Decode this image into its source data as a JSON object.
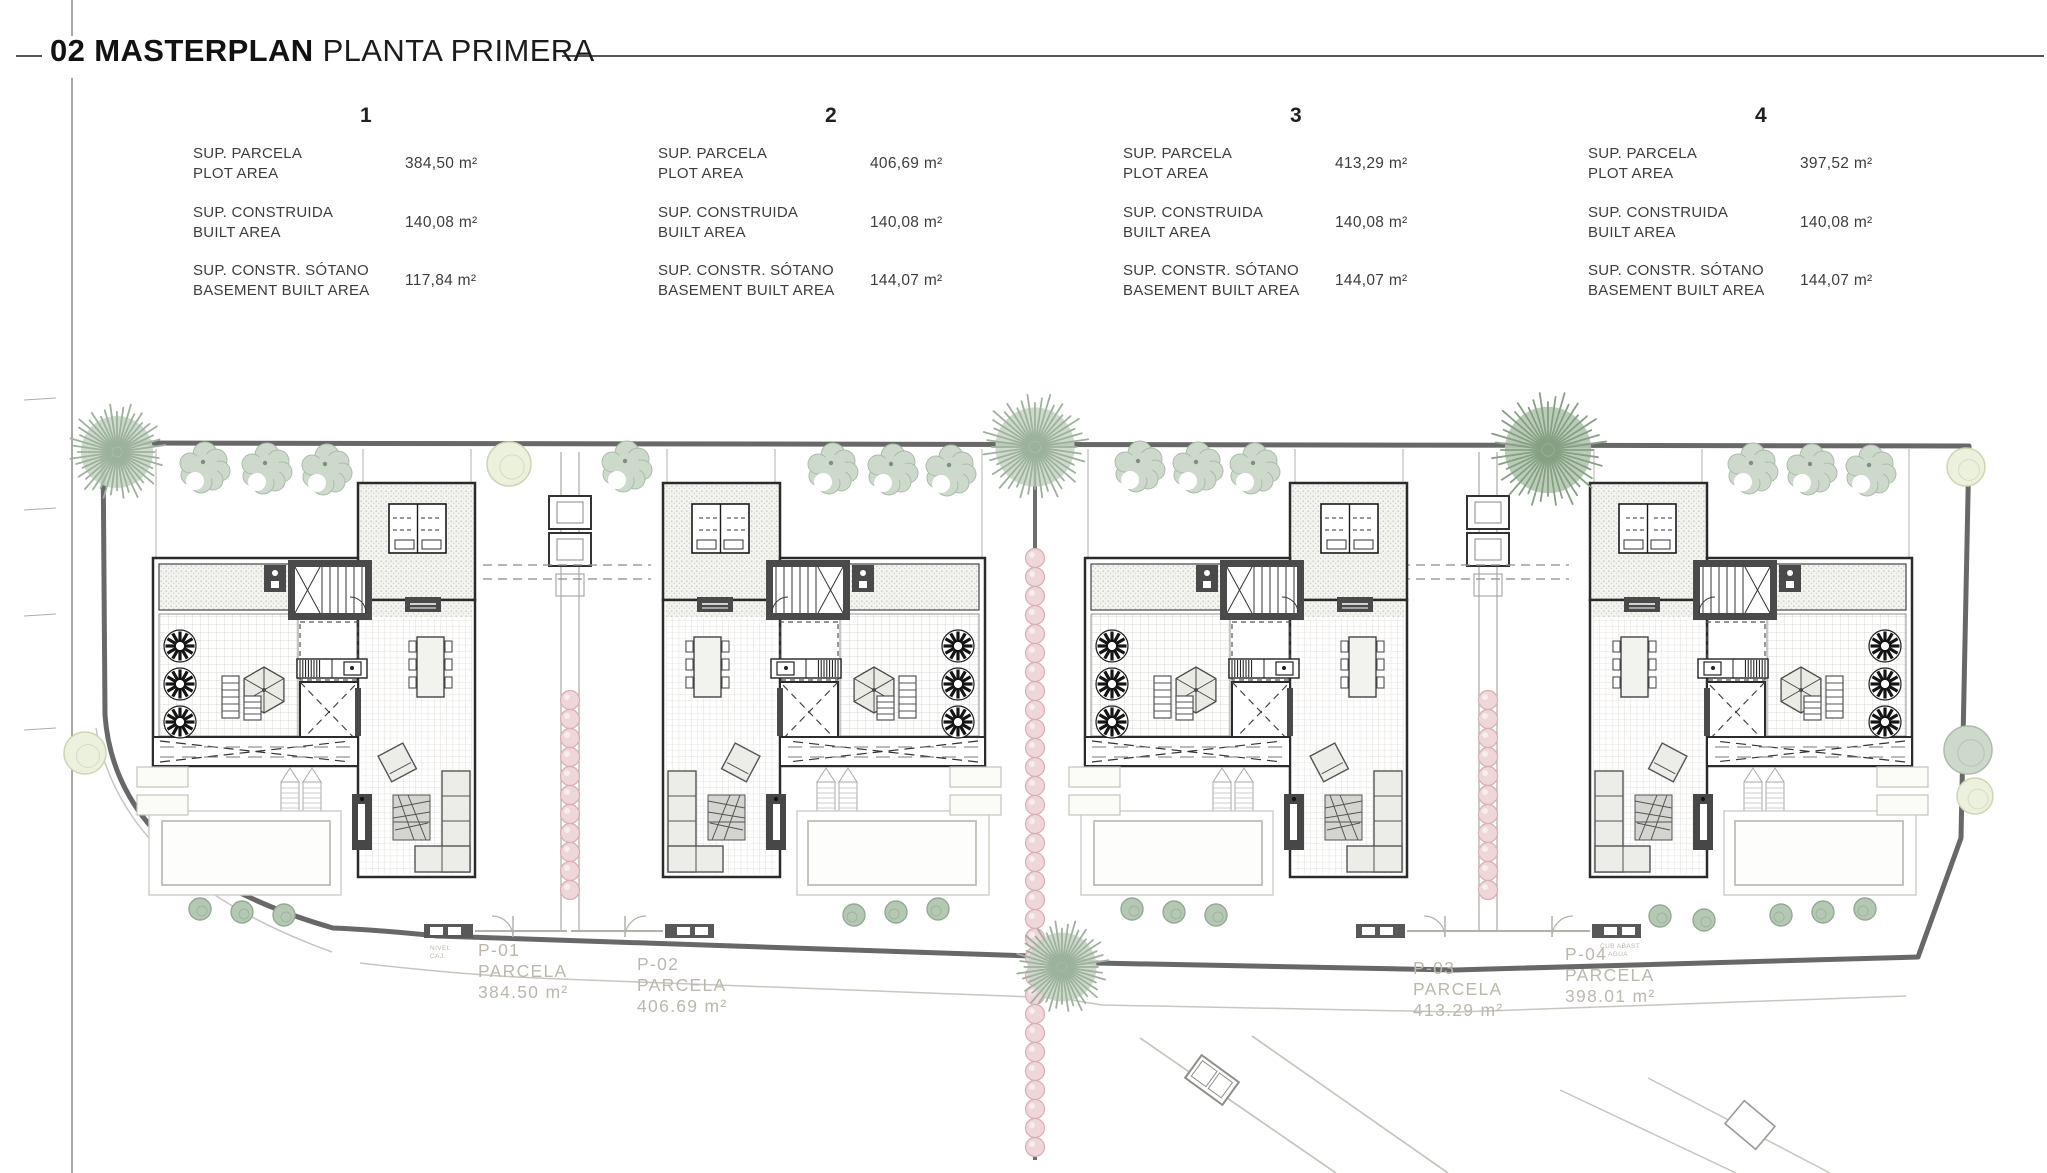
{
  "title": {
    "number_bold": "02 MASTERPLAN",
    "rest": "PLANTA PRIMERA"
  },
  "units": [
    {
      "id": "1",
      "rows": [
        {
          "label_es": "SUP. PARCELA",
          "label_en": "PLOT AREA",
          "value": "384,50 m²"
        },
        {
          "label_es": "SUP. CONSTRUIDA",
          "label_en": "BUILT AREA",
          "value": "140,08 m²"
        },
        {
          "label_es": "SUP. CONSTR. SÓTANO",
          "label_en": "BASEMENT BUILT AREA",
          "value": "117,84 m²"
        }
      ]
    },
    {
      "id": "2",
      "rows": [
        {
          "label_es": "SUP. PARCELA",
          "label_en": "PLOT AREA",
          "value": "406,69 m²"
        },
        {
          "label_es": "SUP. CONSTRUIDA",
          "label_en": "BUILT AREA",
          "value": "140,08 m²"
        },
        {
          "label_es": "SUP. CONSTR. SÓTANO",
          "label_en": "BASEMENT BUILT AREA",
          "value": "144,07 m²"
        }
      ]
    },
    {
      "id": "3",
      "rows": [
        {
          "label_es": "SUP. PARCELA",
          "label_en": "PLOT AREA",
          "value": "413,29 m²"
        },
        {
          "label_es": "SUP. CONSTRUIDA",
          "label_en": "BUILT AREA",
          "value": "140,08 m²"
        },
        {
          "label_es": "SUP. CONSTR. SÓTANO",
          "label_en": "BASEMENT BUILT AREA",
          "value": "144,07 m²"
        }
      ]
    },
    {
      "id": "4",
      "rows": [
        {
          "label_es": "SUP. PARCELA",
          "label_en": "PLOT AREA",
          "value": "397,52 m²"
        },
        {
          "label_es": "SUP. CONSTRUIDA",
          "label_en": "BUILT AREA",
          "value": "140,08 m²"
        },
        {
          "label_es": "SUP. CONSTR. SÓTANO",
          "label_en": "BASEMENT BUILT AREA",
          "value": "144,07 m²"
        }
      ]
    }
  ],
  "parcels": [
    {
      "code": "P-01",
      "label": "PARCELA",
      "area": "384.50 m²"
    },
    {
      "code": "P-02",
      "label": "PARCELA",
      "area": "406.69 m²"
    },
    {
      "code": "P-03",
      "label": "PARCELA",
      "area": "413.29 m²"
    },
    {
      "code": "P-04",
      "label": "PARCELA",
      "area": "398.01 m²"
    }
  ],
  "tiny_labels": [
    {
      "line1": "NIVEL",
      "line2": "CAJ."
    },
    {
      "line1": "CUB ABAST",
      "line2": "AGUA"
    }
  ],
  "colors": {
    "wall_dark": "#2b2b2b",
    "core_gray": "#4a4a4a",
    "boundary": "#686868",
    "road_light": "#c9c6bf",
    "divider": "#6e6e6e",
    "tree_sage_fill": "#cdd9cb",
    "tree_sage_stroke": "#a9bda9",
    "tree_yellow_fill": "#ecf1dd",
    "tree_yellow_stroke": "#ccd6b2",
    "pompom_light": "#c9d6c7",
    "pompom_mid": "#9db29c",
    "pompom_dark_light": "#b4c7b1",
    "pompom_dark_mid": "#85a083",
    "hedge_pink_fill": "#eed6d9",
    "hedge_pink_stroke": "#d9aeb4",
    "parcel_text": "#bcb8ae"
  }
}
